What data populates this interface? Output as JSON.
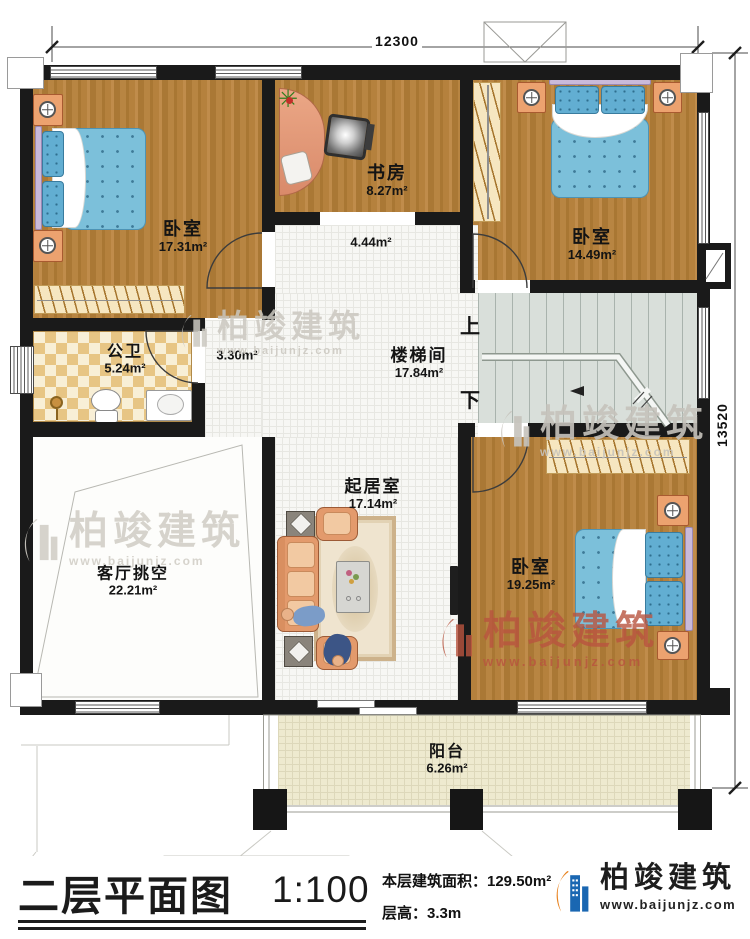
{
  "plan": {
    "dim_top": "12300",
    "dim_right": "13520",
    "stair_up": "上",
    "stair_down": "下",
    "rooms": {
      "bedroom_tl": {
        "name": "卧室",
        "area": "17.31m²"
      },
      "study": {
        "name": "书房",
        "area": "8.27m²"
      },
      "bedroom_tr": {
        "name": "卧室",
        "area": "14.49m²"
      },
      "hall_a": {
        "area": "4.44m²"
      },
      "hall_b": {
        "area": "3.30m²"
      },
      "bath": {
        "name": "公卫",
        "area": "5.24m²"
      },
      "stair": {
        "name": "楼梯间",
        "area": "17.84m²"
      },
      "void": {
        "name": "客厅挑空",
        "area": "22.21m²"
      },
      "family": {
        "name": "起居室",
        "area": "17.14m²"
      },
      "bedroom_br": {
        "name": "卧室",
        "area": "19.25m²"
      },
      "balcony": {
        "name": "阳台",
        "area": "6.26m²"
      }
    }
  },
  "watermark": {
    "brand": "柏竣建筑",
    "url": "www.baijunjz.com"
  },
  "titleblock": {
    "title": "二层平面图",
    "scale": "1:100",
    "area_line": "本层建筑面积：129.50m²",
    "height_line": "层高：3.3m",
    "brand": "柏竣建筑",
    "brand_url": "www.baijunjz.com"
  }
}
